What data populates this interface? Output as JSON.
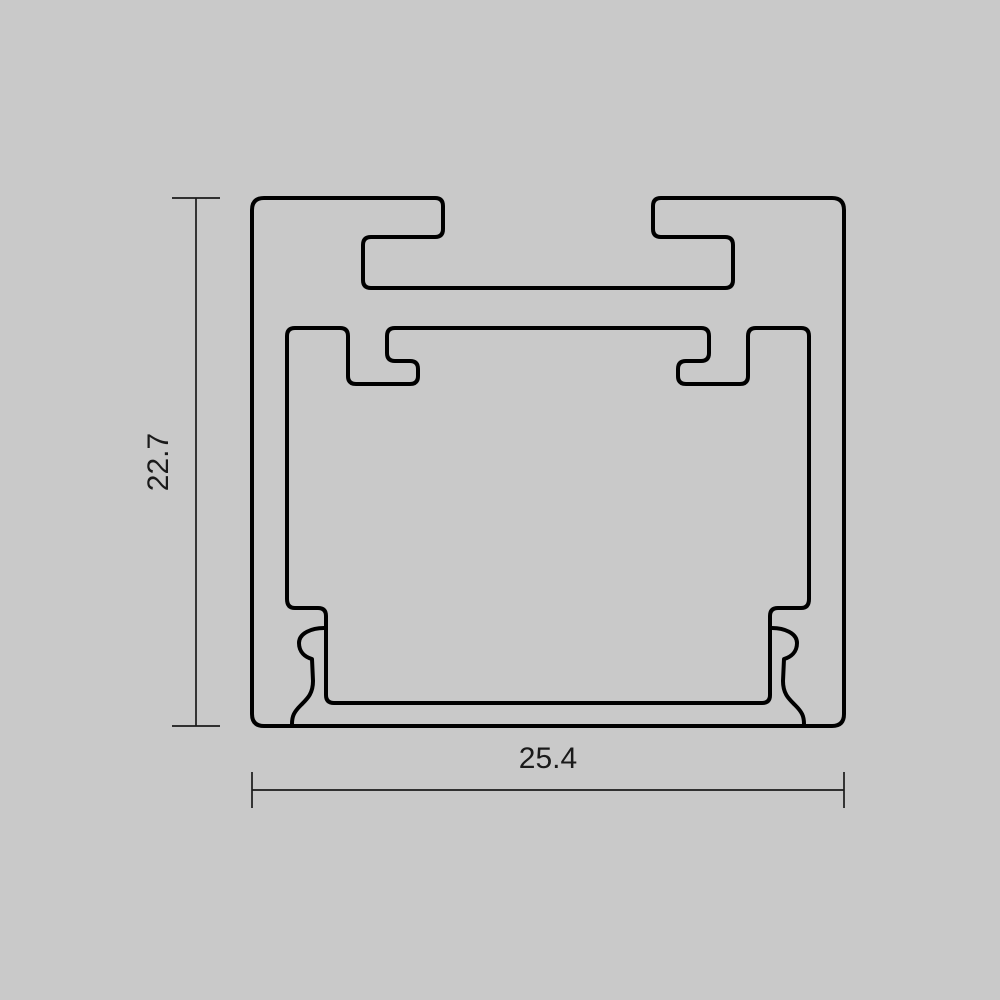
{
  "diagram": {
    "height_dimension": "22.7",
    "width_dimension": "25.4",
    "colors": {
      "background": "#c9c9c9",
      "line": "#000000",
      "dimension": "#1a1a1a"
    }
  }
}
